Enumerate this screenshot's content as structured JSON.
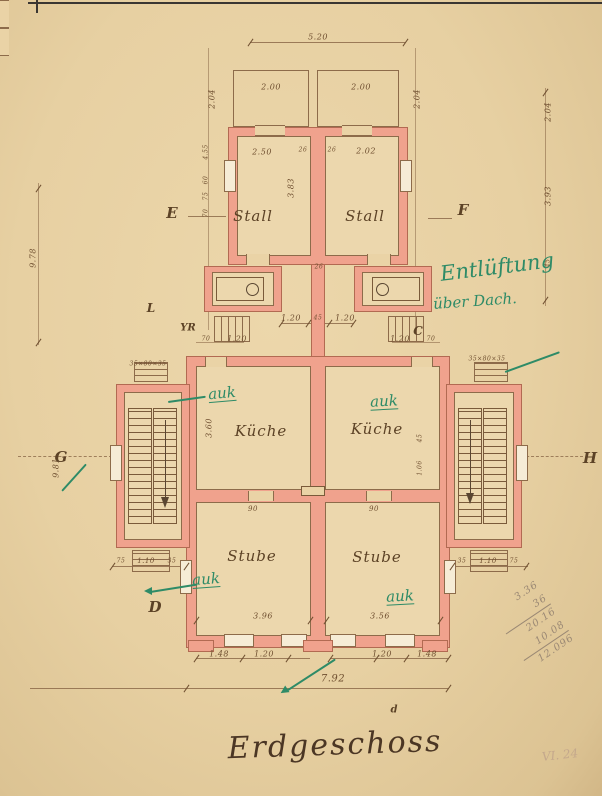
{
  "title": "Erdgeschoss",
  "corner_note": "VI. 24",
  "colors": {
    "paper": "#e8d2a6",
    "wall_fill": "#f0a28d",
    "wall_edge": "#b26a52",
    "ink": "#6f4f30",
    "green_ink": "#2e8b67",
    "pencil": "#9a8874"
  },
  "pencil_calc": {
    "lines": [
      "3.36",
      "36",
      "20.16",
      "10.08",
      "12.096"
    ],
    "underline_after": [
      1,
      3
    ]
  },
  "labels": [
    {
      "t": "5.20",
      "x": 318,
      "y": 37,
      "c": "dim",
      "n": "dim-total-top"
    },
    {
      "t": "2.00",
      "x": 271,
      "y": 87,
      "c": "dim",
      "n": "dim-yard-left"
    },
    {
      "t": "2.00",
      "x": 361,
      "y": 87,
      "c": "dim",
      "n": "dim-yard-right"
    },
    {
      "t": "2.04",
      "x": 212,
      "y": 99,
      "c": "dim",
      "r": -90,
      "n": "dim-yard-depth-left"
    },
    {
      "t": "2.04",
      "x": 417,
      "y": 99,
      "c": "dim",
      "r": -90,
      "n": "dim-yard-depth-right"
    },
    {
      "t": "2.50",
      "x": 262,
      "y": 152,
      "c": "dim",
      "n": "dim-stall-left-width"
    },
    {
      "t": "26",
      "x": 303,
      "y": 150,
      "c": "dim",
      "f": 6,
      "n": "dim-wall"
    },
    {
      "t": "26",
      "x": 332,
      "y": 150,
      "c": "dim",
      "f": 6,
      "n": "dim-wall"
    },
    {
      "t": "2.02",
      "x": 366,
      "y": 151,
      "c": "dim",
      "n": "dim-stall-right-width"
    },
    {
      "t": "3.83",
      "x": 291,
      "y": 188,
      "c": "dim",
      "r": -90,
      "n": "dim-stall-depth"
    },
    {
      "t": "2.04",
      "x": 548,
      "y": 112,
      "c": "dim",
      "r": -90,
      "n": "dim-right-chain-1"
    },
    {
      "t": "3.93",
      "x": 548,
      "y": 196,
      "c": "dim",
      "r": -90,
      "n": "dim-right-chain-2"
    },
    {
      "t": "45",
      "x": 548,
      "y": 263,
      "c": "dim",
      "r": -90,
      "f": 6,
      "n": "dim-right-chain-3"
    },
    {
      "t": "4.55",
      "x": 206,
      "y": 152,
      "c": "dim",
      "r": -90,
      "f": 6,
      "n": "dim-left-chain-1"
    },
    {
      "t": "60",
      "x": 206,
      "y": 180,
      "c": "dim",
      "r": -90,
      "f": 6,
      "n": "dim-left-chain-2"
    },
    {
      "t": "75",
      "x": 206,
      "y": 196,
      "c": "dim",
      "r": -90,
      "f": 6,
      "n": "dim-left-chain-3"
    },
    {
      "t": "70",
      "x": 206,
      "y": 213,
      "c": "dim",
      "r": -90,
      "f": 6,
      "n": "dim-left-chain-4"
    },
    {
      "t": "9.78",
      "x": 33,
      "y": 258,
      "c": "dim",
      "r": -90,
      "n": "dim-overall-left"
    },
    {
      "t": "9.81",
      "x": 56,
      "y": 468,
      "c": "dim",
      "r": -90,
      "n": "dim-left-lower"
    },
    {
      "t": "26",
      "x": 319,
      "y": 267,
      "c": "dim",
      "f": 6,
      "n": "dim-party-wall"
    },
    {
      "t": "1.20",
      "x": 291,
      "y": 318,
      "c": "dim",
      "n": "dim-court-1"
    },
    {
      "t": "45",
      "x": 318,
      "y": 318,
      "c": "dim",
      "f": 6,
      "n": "dim-court-2"
    },
    {
      "t": "1.20",
      "x": 345,
      "y": 318,
      "c": "dim",
      "n": "dim-court-3"
    },
    {
      "t": "70",
      "x": 206,
      "y": 339,
      "c": "dim",
      "f": 6,
      "n": "dim-entry-left-1"
    },
    {
      "t": "1.20",
      "x": 237,
      "y": 339,
      "c": "dim",
      "n": "dim-entry-left-2"
    },
    {
      "t": "1.20",
      "x": 400,
      "y": 339,
      "c": "dim",
      "n": "dim-entry-right-1"
    },
    {
      "t": "70",
      "x": 431,
      "y": 339,
      "c": "dim",
      "f": 6,
      "n": "dim-entry-right-2"
    },
    {
      "t": "35×80×35",
      "x": 148,
      "y": 364,
      "c": "dim",
      "f": 6,
      "n": "dim-window-left"
    },
    {
      "t": "35×80×35",
      "x": 487,
      "y": 359,
      "c": "dim",
      "f": 6,
      "n": "dim-window-right"
    },
    {
      "t": "3.60",
      "x": 209,
      "y": 428,
      "c": "dim",
      "r": -90,
      "n": "dim-kitchen-depth"
    },
    {
      "t": "45",
      "x": 420,
      "y": 438,
      "c": "dim",
      "r": -90,
      "f": 6,
      "n": "dim-kitchen-right-1"
    },
    {
      "t": "1.06",
      "x": 420,
      "y": 468,
      "c": "dim",
      "r": -90,
      "f": 6,
      "n": "dim-kitchen-right-2"
    },
    {
      "t": "90",
      "x": 253,
      "y": 509,
      "c": "dim",
      "f": 7,
      "n": "dim-door-left"
    },
    {
      "t": "90",
      "x": 374,
      "y": 509,
      "c": "dim",
      "f": 7,
      "n": "dim-door-right"
    },
    {
      "t": "75",
      "x": 121,
      "y": 561,
      "c": "dim",
      "f": 6,
      "n": "dim-tower-left-1"
    },
    {
      "t": "1.10",
      "x": 146,
      "y": 561,
      "c": "dim",
      "f": 7,
      "n": "dim-tower-left-2"
    },
    {
      "t": "35",
      "x": 172,
      "y": 561,
      "c": "dim",
      "f": 6,
      "n": "dim-tower-left-3"
    },
    {
      "t": "35",
      "x": 462,
      "y": 561,
      "c": "dim",
      "f": 6,
      "n": "dim-tower-right-1"
    },
    {
      "t": "1.10",
      "x": 488,
      "y": 561,
      "c": "dim",
      "f": 7,
      "n": "dim-tower-right-2"
    },
    {
      "t": "75",
      "x": 514,
      "y": 561,
      "c": "dim",
      "f": 6,
      "n": "dim-tower-right-3"
    },
    {
      "t": "3.96",
      "x": 263,
      "y": 616,
      "c": "dim",
      "n": "dim-stube-left-width"
    },
    {
      "t": "3.56",
      "x": 380,
      "y": 616,
      "c": "dim",
      "n": "dim-stube-right-width"
    },
    {
      "t": "1.48",
      "x": 219,
      "y": 654,
      "c": "dim",
      "n": "dim-bottom-1"
    },
    {
      "t": "1.20",
      "x": 264,
      "y": 654,
      "c": "dim",
      "n": "dim-bottom-2"
    },
    {
      "t": "1.20",
      "x": 382,
      "y": 654,
      "c": "dim",
      "n": "dim-bottom-3"
    },
    {
      "t": "1.48",
      "x": 427,
      "y": 654,
      "c": "dim",
      "n": "dim-bottom-4"
    },
    {
      "t": "7.92",
      "x": 333,
      "y": 679,
      "c": "dim",
      "f": 10,
      "n": "dim-total-bottom"
    },
    {
      "t": "Stall",
      "x": 253,
      "y": 216,
      "c": "room",
      "n": "room-stall-left"
    },
    {
      "t": "Stall",
      "x": 365,
      "y": 216,
      "c": "room",
      "n": "room-stall-right"
    },
    {
      "t": "Küche",
      "x": 261,
      "y": 431,
      "c": "room",
      "n": "room-kueche-left"
    },
    {
      "t": "Küche",
      "x": 377,
      "y": 429,
      "c": "room",
      "n": "room-kueche-right"
    },
    {
      "t": "Stube",
      "x": 252,
      "y": 556,
      "c": "room",
      "n": "room-stube-left"
    },
    {
      "t": "Stube",
      "x": 377,
      "y": 557,
      "c": "room",
      "n": "room-stube-right"
    },
    {
      "t": "E",
      "x": 172,
      "y": 213,
      "c": "marker",
      "n": "section-marker-e"
    },
    {
      "t": "F",
      "x": 463,
      "y": 210,
      "c": "marker",
      "n": "section-marker-f"
    },
    {
      "t": "G",
      "x": 61,
      "y": 457,
      "c": "marker",
      "n": "section-marker-g"
    },
    {
      "t": "H",
      "x": 590,
      "y": 458,
      "c": "marker",
      "n": "section-marker-h"
    },
    {
      "t": "L",
      "x": 151,
      "y": 308,
      "c": "marker",
      "f": 12,
      "n": "section-marker-l"
    },
    {
      "t": "C",
      "x": 418,
      "y": 331,
      "c": "marker",
      "f": 12,
      "n": "section-marker-c"
    },
    {
      "t": "D",
      "x": 155,
      "y": 607,
      "c": "marker",
      "n": "section-marker-d"
    },
    {
      "t": "YR",
      "x": 188,
      "y": 328,
      "c": "marker",
      "f": 10,
      "n": "ink-initials"
    },
    {
      "t": "d",
      "x": 394,
      "y": 710,
      "c": "marker",
      "f": 10,
      "n": "small-mark-d"
    },
    {
      "t": "Entlüftung",
      "x": 497,
      "y": 267,
      "c": "green",
      "r": -7,
      "f": 21,
      "n": "green-note-entlueftung"
    },
    {
      "t": "über Dach.",
      "x": 475,
      "y": 301,
      "c": "green",
      "r": -4,
      "f": 15,
      "n": "green-note-ueber-dach"
    },
    {
      "t": "auk",
      "x": 222,
      "y": 393,
      "c": "green u",
      "r": -5,
      "n": "green-note-auk-kueche-left"
    },
    {
      "t": "auk",
      "x": 384,
      "y": 401,
      "c": "green u",
      "r": -3,
      "n": "green-note-auk-kueche-right"
    },
    {
      "t": "auk",
      "x": 206,
      "y": 579,
      "c": "green u",
      "r": -4,
      "n": "green-note-auk-stube-left"
    },
    {
      "t": "auk",
      "x": 400,
      "y": 596,
      "c": "green u",
      "r": -3,
      "n": "green-note-auk-stube-right"
    }
  ]
}
